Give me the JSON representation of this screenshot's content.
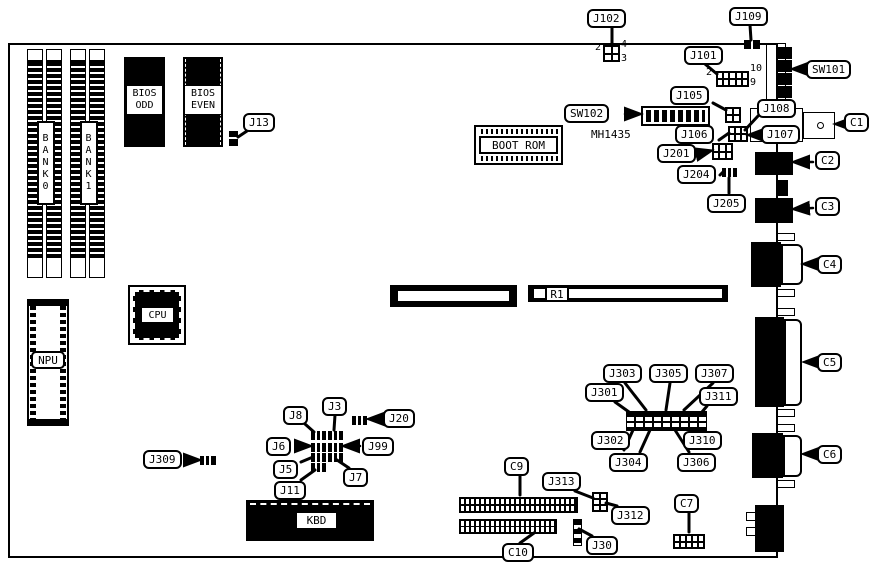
{
  "colors": {
    "ink": "#000000",
    "paper": "#ffffff"
  },
  "callouts": {
    "j102": "J102",
    "j109": "J109",
    "j101": "J101",
    "j13": "J13",
    "sw101": "SW101",
    "sw102": "SW102",
    "j105": "J105",
    "j106": "J106",
    "j107": "J107",
    "j108": "J108",
    "j201": "J201",
    "j204": "J204",
    "j205": "J205",
    "c1": "C1",
    "c2": "C2",
    "c3": "C3",
    "c4": "C4",
    "c5": "C5",
    "c6": "C6",
    "c7": "C7",
    "c9": "C9",
    "c10": "C10",
    "j8": "J8",
    "j3": "J3",
    "j20": "J20",
    "j6": "J6",
    "j99": "J99",
    "j5": "J5",
    "j7": "J7",
    "j11": "J11",
    "j309": "J309",
    "j301": "J301",
    "j302": "J302",
    "j303": "J303",
    "j304": "J304",
    "j305": "J305",
    "j306": "J306",
    "j307": "J307",
    "j310": "J310",
    "j311": "J311",
    "j313": "J313",
    "j312": "J312",
    "j30": "J30"
  },
  "components": {
    "bank0": "BANK0",
    "bank1": "BANK1",
    "bios_odd": [
      "BIOS",
      "ODD"
    ],
    "bios_even": [
      "BIOS",
      "EVEN"
    ],
    "boot_rom": "BOOT ROM",
    "cpu": "CPU",
    "npu": "NPU",
    "kbd": "KBD",
    "r1": "R1"
  },
  "annotations": {
    "sw102_part": "MH1435",
    "j102_pin2": "2",
    "j102_pin4": "4",
    "j102_pin3": "3",
    "j101_pin2": "2",
    "j101_pin10": "10",
    "j101_pin9": "9"
  }
}
